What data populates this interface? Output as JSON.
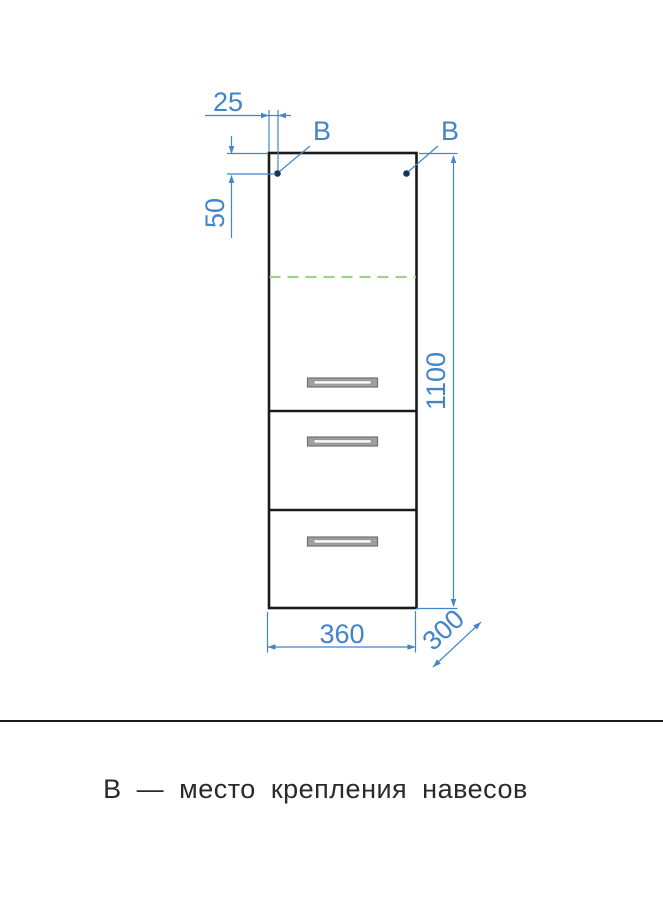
{
  "drawing": {
    "labels": {
      "mount_left": "В",
      "mount_right": "В"
    },
    "dimensions": {
      "mount_offset_x": "25",
      "mount_offset_y": "50",
      "height": "1100",
      "width": "360",
      "depth": "300"
    }
  },
  "caption": "В — место крепления навесов",
  "colors": {
    "dimension_blue": "#4285c8",
    "outline_black": "#1b1b1b",
    "shelf_green": "#9dd28f",
    "mount_dot": "#15355a",
    "handle_gray": "#a0a0a0"
  }
}
